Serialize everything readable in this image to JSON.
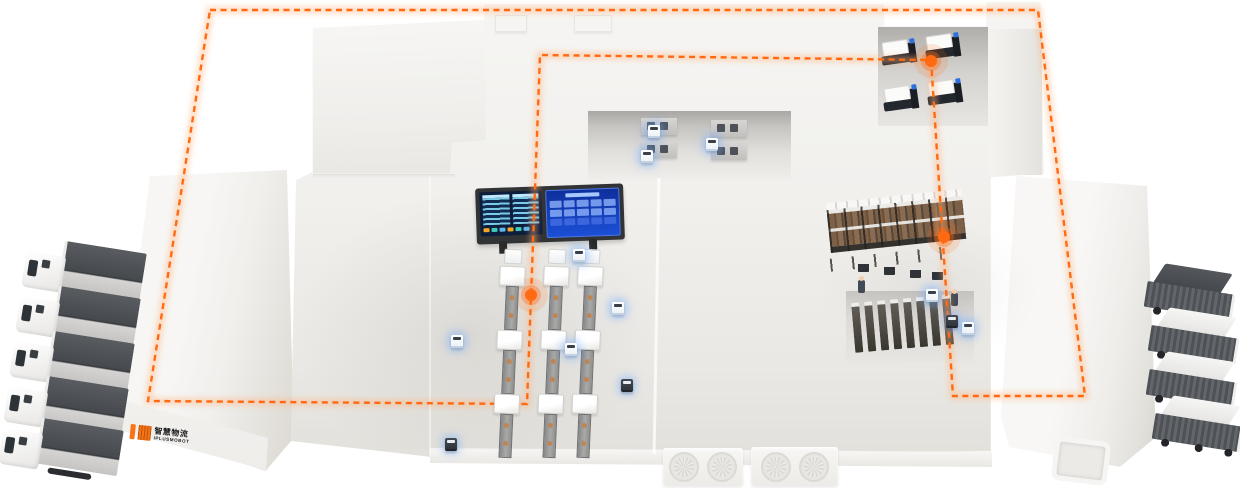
{
  "meta": {
    "description": "Isometric 3D illustration of a smart logistics factory: white warehouse slabs, AMR robots, conveyor sorter lines, monitoring screen, storage rack, docked trucks and a closed orange dashed AGV route loop with glowing waypoints",
    "canvas": {
      "width": 1240,
      "height": 488
    },
    "background_color": "#ffffff",
    "accent_color": "#ff6a13"
  },
  "brand_badge": {
    "mark_color": "#f97316",
    "line1": "智慧物流",
    "line2": "IPLUSMOBOT",
    "text_color": "#17181a"
  },
  "route": {
    "color": "#ff6a13",
    "glow_color": "#ffb27a",
    "dash_pattern": "6 4.5",
    "closed": true,
    "points": [
      [
        210,
        10
      ],
      [
        1038,
        10
      ],
      [
        1085,
        396
      ],
      [
        953,
        396
      ],
      [
        931,
        60
      ],
      [
        540,
        55
      ],
      [
        527,
        404
      ],
      [
        148,
        401
      ]
    ],
    "waypoints": [
      {
        "x": 531,
        "y": 295,
        "label": "sorter-line-stop"
      },
      {
        "x": 931,
        "y": 61,
        "label": "test-bay-stop"
      },
      {
        "x": 944,
        "y": 237,
        "label": "rack-aisle-stop"
      }
    ]
  },
  "zones": {
    "left_dock_building": "dock building with brand badge",
    "main_hall": "production hall with sorter lines and monitor screen",
    "top_equipment_bay": "four workstations served by AMRs",
    "test_machine_bay": "four bench machines in top-right recess",
    "storage_rack": "pallet rack with carton boxes",
    "cabinet_row": "row of eight vertical cabinets",
    "right_dock_building": "dock building with door cut-out",
    "roof_vents": "two fan vent blocks at bottom edge"
  },
  "fleet": {
    "trucks_left": 5,
    "trucks_right": 4,
    "white_amrs": 9,
    "dark_amrs": 3,
    "rack_shuttles": 4,
    "workers": 2,
    "sorter_columns": 3
  },
  "monitor_screen": {
    "frame_color": "#323335",
    "left_panel_color": "#0d1d3c",
    "right_panel_color": "#1b4fd6",
    "row_color": "#7fd4f0",
    "status_colors": [
      "#f5a623",
      "#41c9b8",
      "#5fb7e8",
      "#f5a623",
      "#41c9b8",
      "#5fb7e8"
    ]
  }
}
